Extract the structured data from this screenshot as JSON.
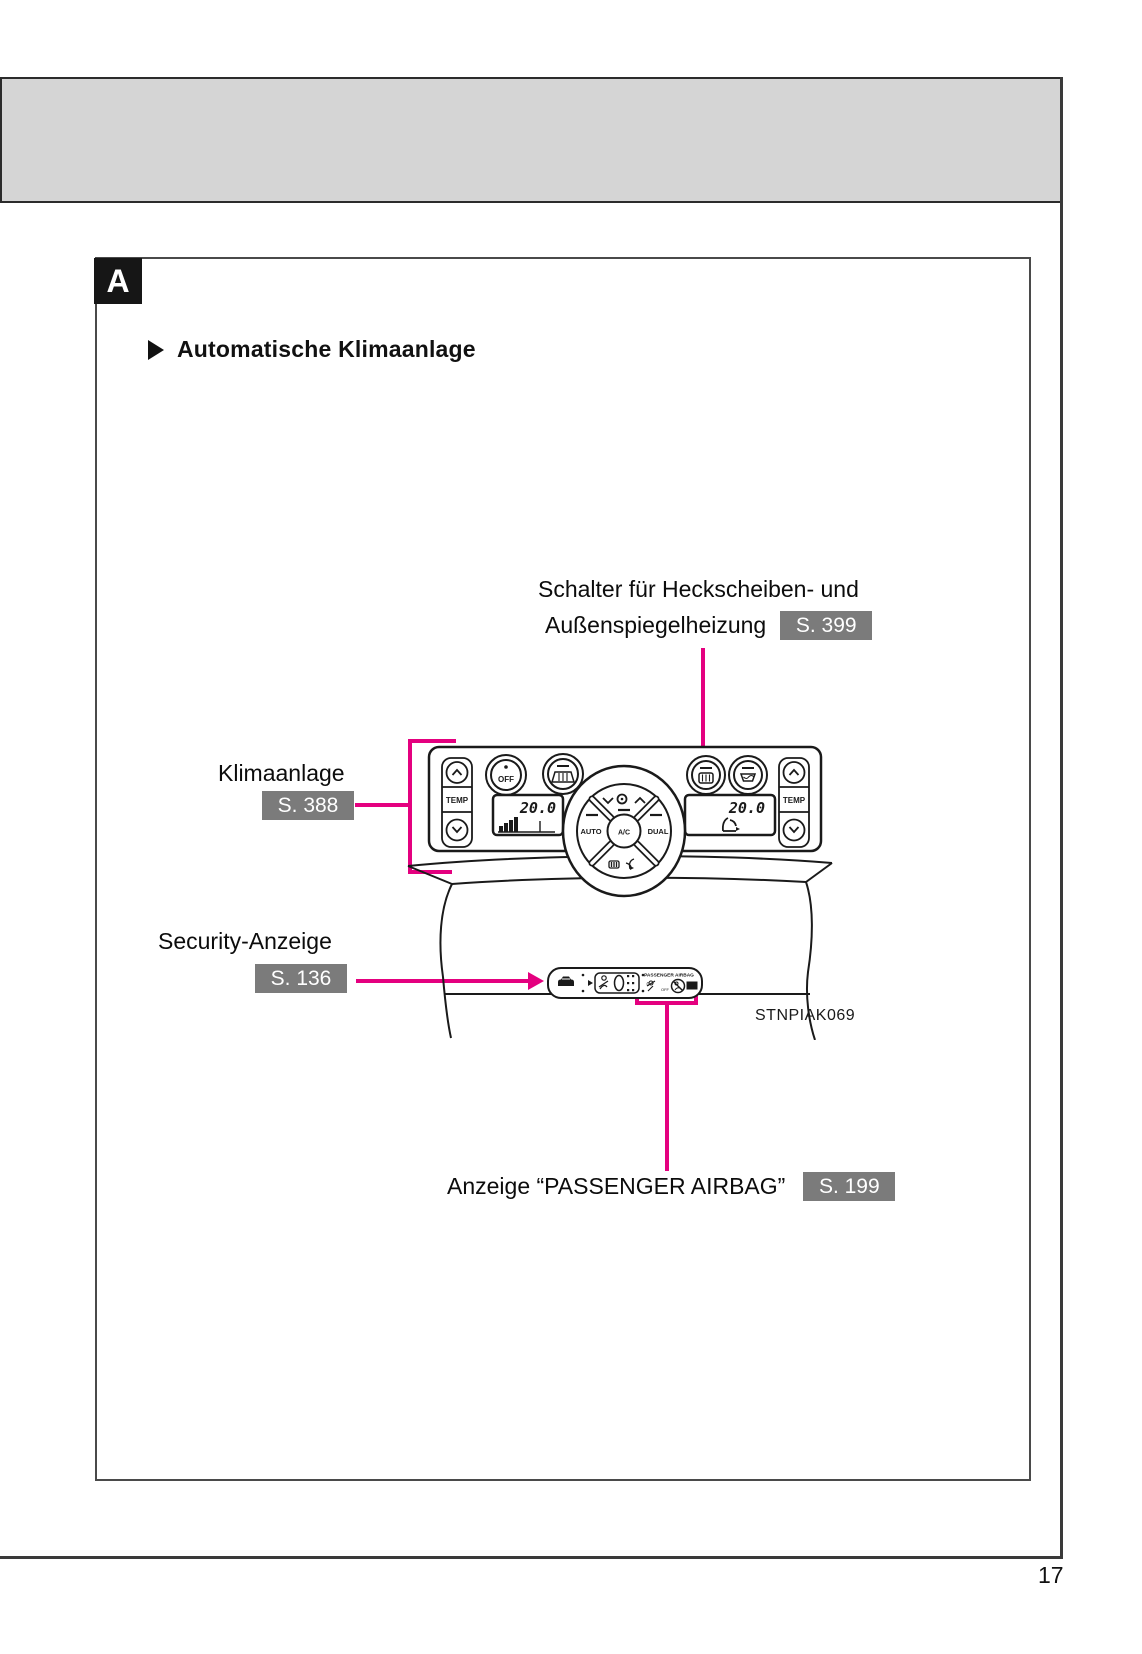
{
  "page_number": "17",
  "tab": {
    "letter": "A"
  },
  "heading": {
    "label": "Automatische Klimaanlage"
  },
  "figure": {
    "code": "STNPIAK069",
    "panel": {
      "temp": "TEMP",
      "off": "OFF",
      "auto": "AUTO",
      "ac": "A/C",
      "dual": "DUAL",
      "temp_left_value": "20.0",
      "temp_right_value": "20.0"
    },
    "cluster": {
      "title": "PASSENGER AIRBAG",
      "off": "OFF",
      "on": "ON",
      "zero": "0"
    }
  },
  "callouts": {
    "defroster": {
      "line1": "Schalter für Heckscheiben- und",
      "line2": "Außenspiegelheizung",
      "ref": "S. 399"
    },
    "climate": {
      "label": "Klimaanlage",
      "ref": "S. 388"
    },
    "security": {
      "label": "Security-Anzeige",
      "ref": "S. 136"
    },
    "airbag": {
      "label": "Anzeige “PASSENGER AIRBAG”",
      "ref": "S. 199"
    }
  },
  "colors": {
    "callout_line": "#e4007f",
    "badge_bg": "#7b7b7b",
    "band_bg": "#d5d5d5"
  }
}
